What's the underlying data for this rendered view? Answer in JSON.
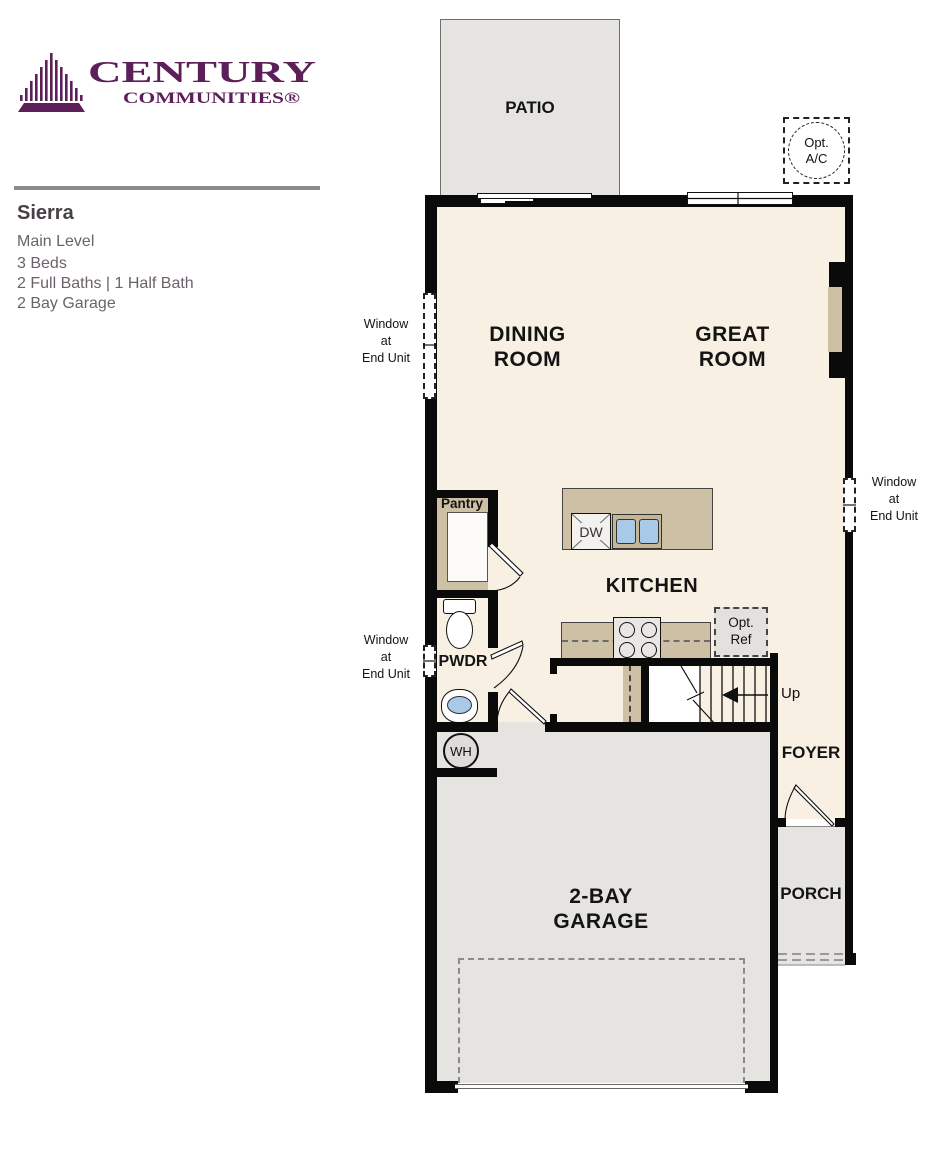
{
  "header": {
    "logo_line1": "CENTURY",
    "logo_line2": "COMMUNITIES®",
    "plan_name": "Sierra",
    "details": [
      "Main Level",
      "3 Beds",
      "2 Full Baths | 1 Half Bath",
      "2 Bay Garage"
    ]
  },
  "rooms": {
    "patio": "PATIO",
    "dining_l1": "DINING",
    "dining_l2": "ROOM",
    "great_l1": "GREAT",
    "great_l2": "ROOM",
    "kitchen": "KITCHEN",
    "pantry": "Pantry",
    "powder": "PWDR",
    "foyer": "FOYER",
    "porch": "PORCH",
    "garage_l1": "2-BAY",
    "garage_l2": "GARAGE"
  },
  "annotations": {
    "window_end_unit_l1": "Window",
    "window_end_unit_l2": "at",
    "window_end_unit_l3": "End Unit",
    "opt_ac_l1": "Opt.",
    "opt_ac_l2": "A/C",
    "opt_ref_l1": "Opt.",
    "opt_ref_l2": "Ref",
    "dishwasher": "DW",
    "water_heater": "WH",
    "stairs_up": "Up"
  },
  "colors": {
    "brand_purple": "#5C1F59",
    "floor_cream": "#F8F0E3",
    "hardscape_gray": "#E5E4E1",
    "counter_tan": "#CDC0A4",
    "wall_black": "#0A0A0A",
    "sink_blue": "#A9C9E9",
    "header_text": "#6B626B"
  }
}
